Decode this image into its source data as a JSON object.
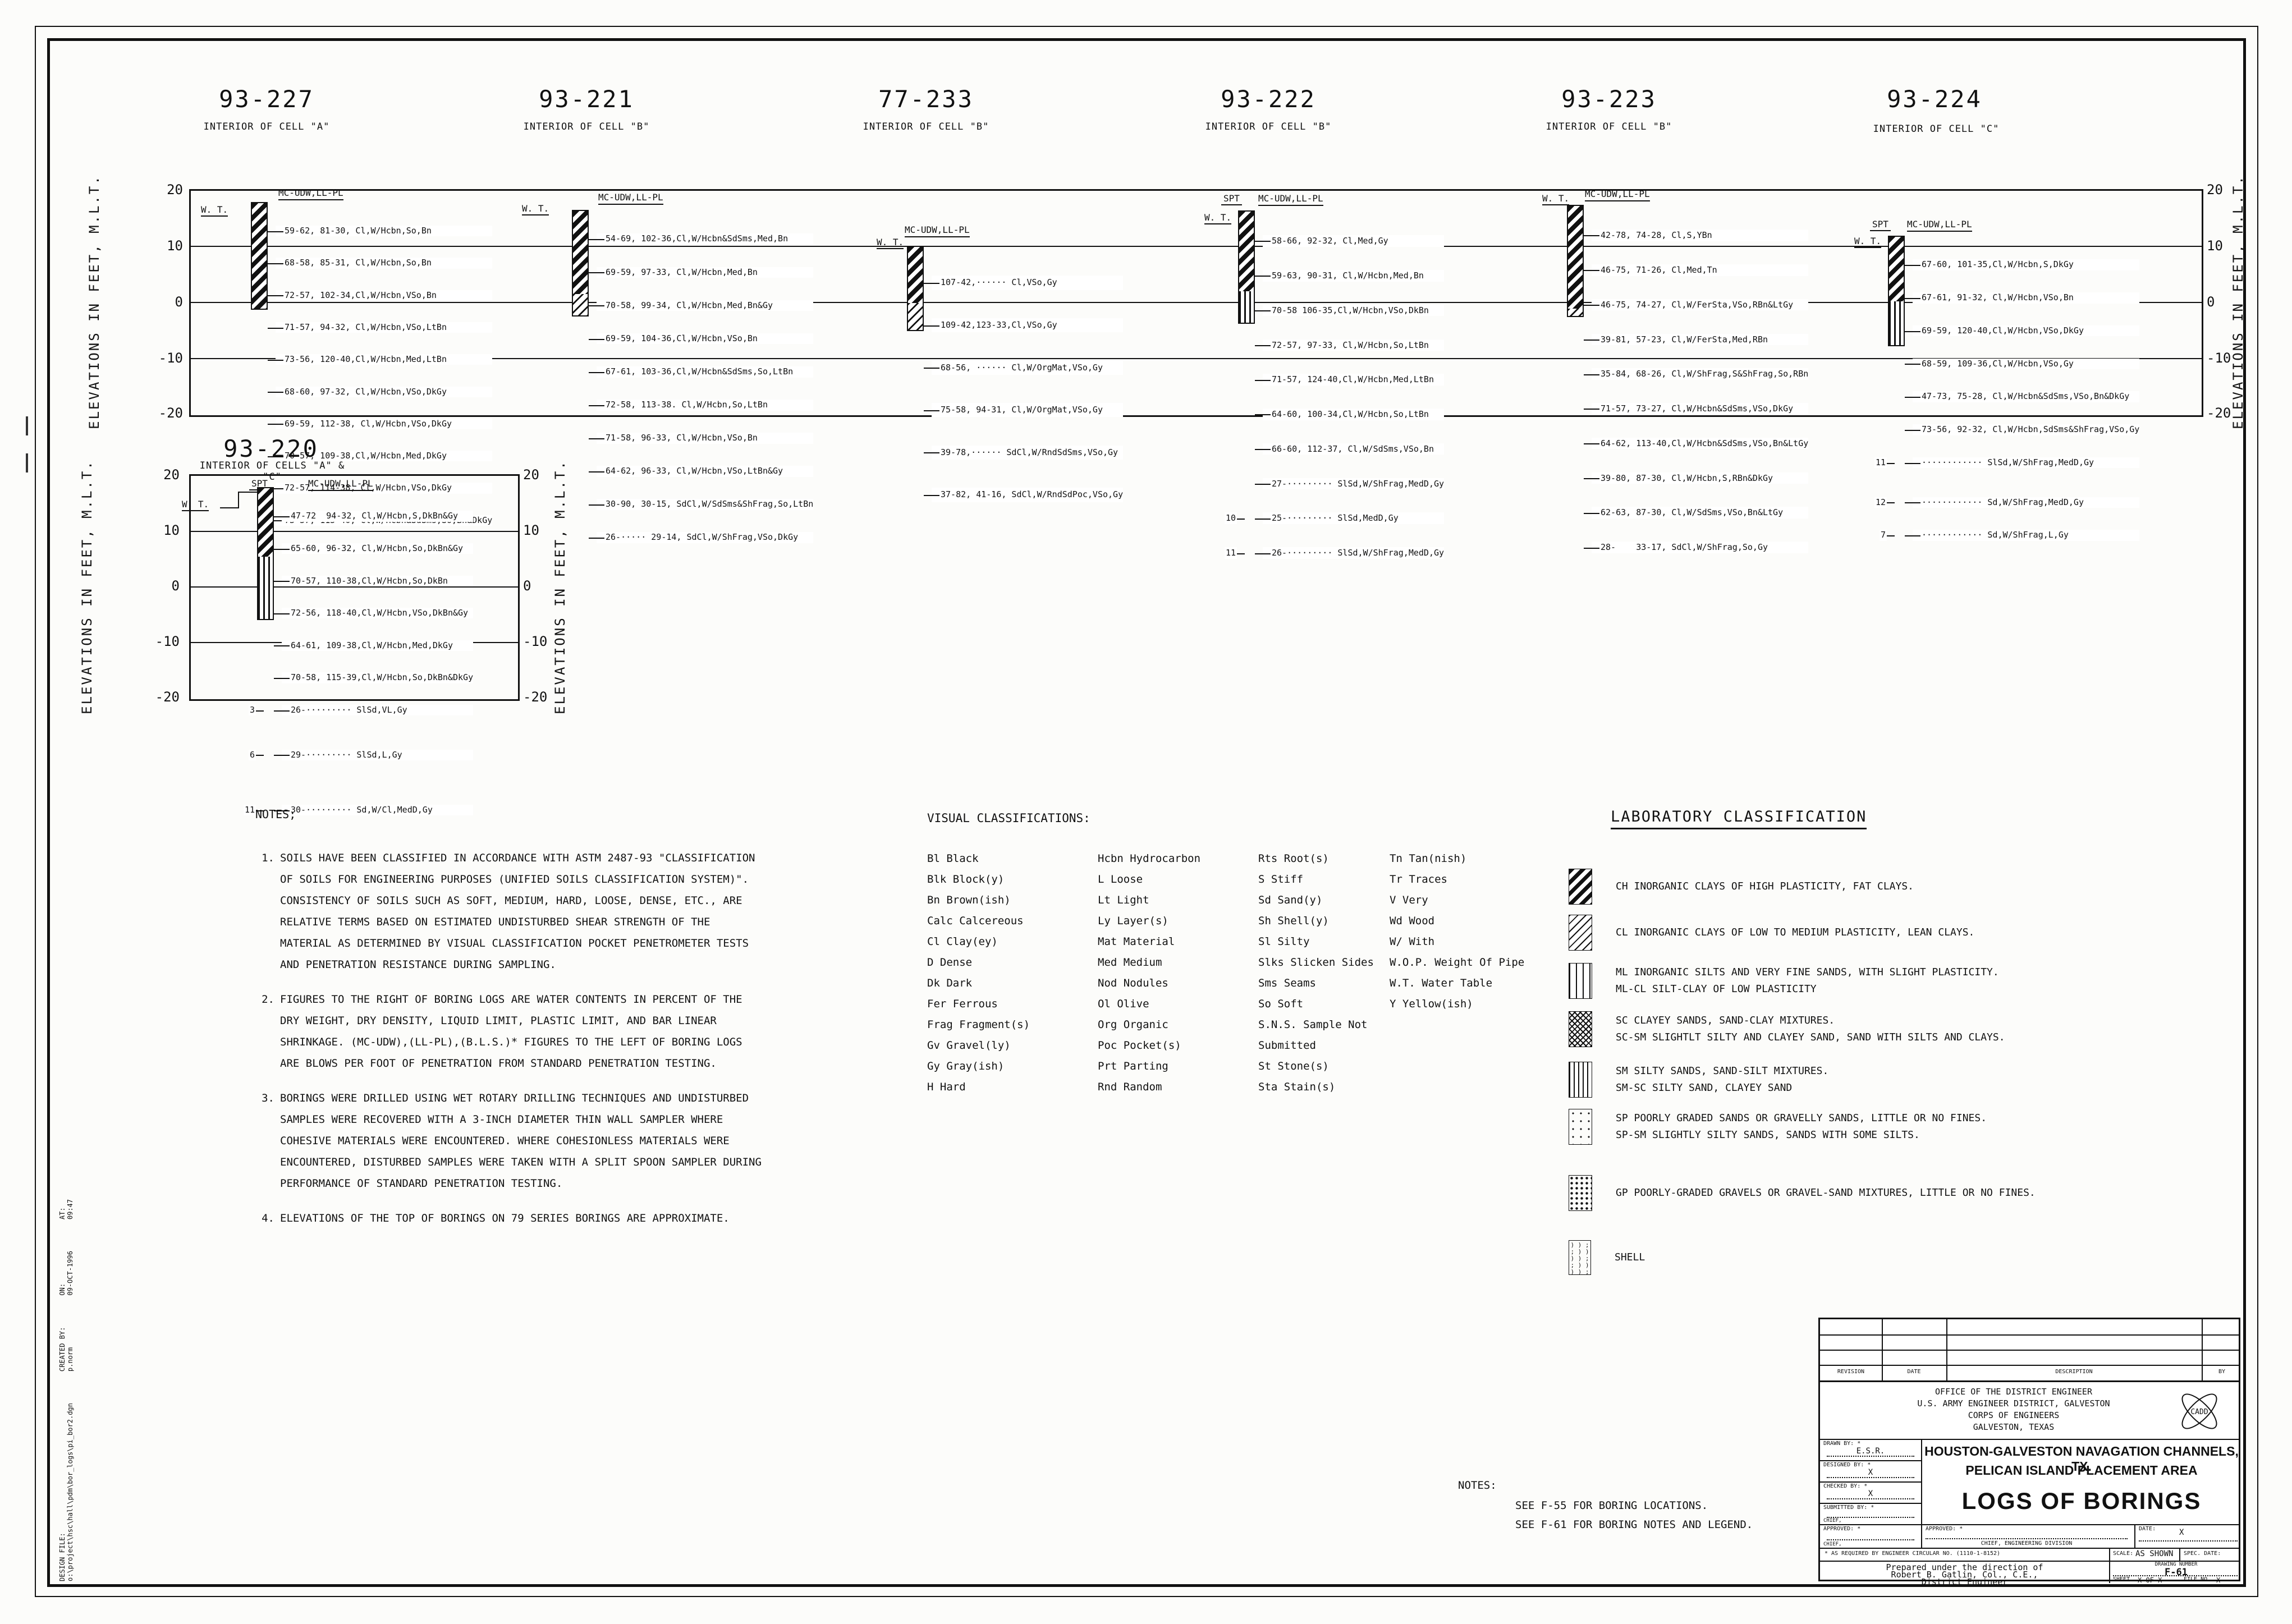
{
  "sheet": {
    "axis_label": "ELEVATIONS IN FEET, M.L.T.",
    "ticks": [
      "20",
      "10",
      "0",
      "-10",
      "-20"
    ],
    "wt": "W. T.",
    "spt": "SPT",
    "mc": "MC-UDW,LL-PL"
  },
  "borings": {
    "b227": {
      "title": "93-227",
      "subtitle": "INTERIOR OF CELL \"A\"",
      "entries": [
        {
          "t": "59-62, 81-30, Cl,W/Hcbn,So,Bn"
        },
        {
          "t": "68-58, 85-31, Cl,W/Hcbn,So,Bn"
        },
        {
          "t": "72-57, 102-34,Cl,W/Hcbn,VSo,Bn"
        },
        {
          "t": "71-57, 94-32, Cl,W/Hcbn,VSo,LtBn"
        },
        {
          "t": "73-56, 120-40,Cl,W/Hcbn,Med,LtBn"
        },
        {
          "t": "68-60, 97-32, Cl,W/Hcbn,VSo,DkGy"
        },
        {
          "t": "69-59, 112-38, Cl,W/Hcbn,VSo,DkGy"
        },
        {
          "t": "70-57, 109-38,Cl,W/Hcbn,Med,DkGy"
        },
        {
          "t": "72-57, 114-38, Cl,W/Hcbn,VSo,DkGy"
        },
        {
          "t": "73-57, 115-40, Cl,W/Hcbn&SdSms,So,Bn&DkGy"
        }
      ]
    },
    "b221": {
      "title": "93-221",
      "subtitle": "INTERIOR OF CELL \"B\"",
      "entries": [
        {
          "t": "54-69, 102-36,Cl,W/Hcbn&SdSms,Med,Bn"
        },
        {
          "t": "69-59, 97-33, Cl,W/Hcbn,Med,Bn"
        },
        {
          "t": "70-58, 99-34, Cl,W/Hcbn,Med,Bn&Gy"
        },
        {
          "t": "69-59, 104-36,Cl,W/Hcbn,VSo,Bn"
        },
        {
          "t": "67-61, 103-36,Cl,W/Hcbn&SdSms,So,LtBn"
        },
        {
          "t": "72-58, 113-38. Cl,W/Hcbn,So,LtBn"
        },
        {
          "t": "71-58, 96-33, Cl,W/Hcbn,VSo,Bn"
        },
        {
          "t": "64-62, 96-33, Cl,W/Hcbn,VSo,LtBn&Gy"
        },
        {
          "t": "30-90, 30-15, SdCl,W/SdSms&ShFrag,So,LtBn"
        },
        {
          "t": "26-····· 29-14, SdCl,W/ShFrag,VSo,DkGy"
        }
      ]
    },
    "b233": {
      "title": "77-233",
      "subtitle": "INTERIOR OF CELL \"B\"",
      "entries": [
        {
          "t": "107-42,······ Cl,VSo,Gy"
        },
        {
          "t": "109-42,123-33,Cl,VSo,Gy"
        },
        {
          "t": "68-56, ······ Cl,W/OrgMat,VSo,Gy"
        },
        {
          "t": "75-58, 94-31, Cl,W/OrgMat,VSo,Gy"
        },
        {
          "t": "39-78,······ SdCl,W/RndSdSms,VSo,Gy"
        },
        {
          "t": "37-82, 41-16, SdCl,W/RndSdPoc,VSo,Gy"
        }
      ]
    },
    "b222": {
      "title": "93-222",
      "subtitle": "INTERIOR OF CELL \"B\"",
      "entries": [
        {
          "t": "58-66, 92-32, Cl,Med,Gy"
        },
        {
          "t": "59-63, 90-31, Cl,W/Hcbn,Med,Bn"
        },
        {
          "t": "70-58 106-35,Cl,W/Hcbn,VSo,DkBn"
        },
        {
          "t": "72-57, 97-33, Cl,W/Hcbn,So,LtBn"
        },
        {
          "t": "71-57, 124-40,Cl,W/Hcbn,Med,LtBn"
        },
        {
          "t": "64-60, 100-34,Cl,W/Hcbn,So,LtBn"
        },
        {
          "t": "66-60, 112-37, Cl,W/SdSms,VSo,Bn"
        },
        {
          "t": "27-········· SlSd,W/ShFrag,MedD,Gy"
        },
        {
          "l": "10",
          "t": "25-········· SlSd,MedD,Gy"
        },
        {
          "l": "11",
          "t": "26-········· SlSd,W/ShFrag,MedD,Gy"
        }
      ]
    },
    "b223": {
      "title": "93-223",
      "subtitle": "INTERIOR OF CELL \"B\"",
      "entries": [
        {
          "t": "42-78, 74-28, Cl,S,YBn"
        },
        {
          "t": "46-75, 71-26, Cl,Med,Tn"
        },
        {
          "t": "46-75, 74-27, Cl,W/FerSta,VSo,RBn&LtGy"
        },
        {
          "t": "39-81, 57-23, Cl,W/FerSta,Med,RBn"
        },
        {
          "t": "35-84, 68-26, Cl,W/ShFrag,S&ShFrag,So,RBn"
        },
        {
          "t": "71-57, 73-27, Cl,W/Hcbn&SdSms,VSo,DkGy"
        },
        {
          "t": "64-62, 113-40,Cl,W/Hcbn&SdSms,VSo,Bn&LtGy"
        },
        {
          "t": "39-80, 87-30, Cl,W/Hcbn,S,RBn&DkGy"
        },
        {
          "t": "62-63, 87-30, Cl,W/SdSms,VSo,Bn&LtGy"
        },
        {
          "t": "28-    33-17, SdCl,W/ShFrag,So,Gy"
        }
      ]
    },
    "b224": {
      "title": "93-224",
      "subtitle": "INTERIOR OF CELL \"C\"",
      "entries": [
        {
          "t": "67-60, 101-35,Cl,W/Hcbn,S,DkGy"
        },
        {
          "t": "67-61, 91-32, Cl,W/Hcbn,VSo,Bn"
        },
        {
          "t": "69-59, 120-40,Cl,W/Hcbn,VSo,DkGy"
        },
        {
          "t": "68-59, 109-36,Cl,W/Hcbn,VSo,Gy"
        },
        {
          "t": "47-73, 75-28, Cl,W/Hcbn&SdSms,VSo,Bn&DkGy"
        },
        {
          "t": "73-56, 92-32, Cl,W/Hcbn,SdSms&ShFrag,VSo,Gy"
        },
        {
          "l": "11",
          "t": "············ SlSd,W/ShFrag,MedD,Gy"
        },
        {
          "l": "12",
          "t": "············ Sd,W/ShFrag,MedD,Gy"
        },
        {
          "l": "7",
          "t": "············ Sd,W/ShFrag,L,Gy"
        }
      ]
    },
    "b220": {
      "title": "93-220",
      "subtitle": "INTERIOR OF CELLS \"A\" & \"C\"",
      "entries": [
        {
          "t": "47-72  94-32, Cl,W/Hcbn,S,DkBn&Gy"
        },
        {
          "t": "65-60, 96-32, Cl,W/Hcbn,So,DkBn&Gy"
        },
        {
          "t": "70-57, 110-38,Cl,W/Hcbn,So,DkBn"
        },
        {
          "t": "72-56, 118-40,Cl,W/Hcbn,VSo,DkBn&Gy"
        },
        {
          "t": "64-61, 109-38,Cl,W/Hcbn,Med,DkGy"
        },
        {
          "t": "70-58, 115-39,Cl,W/Hcbn,So,DkBn&DkGy"
        },
        {
          "l": "3",
          "t": "26-········· SlSd,VL,Gy"
        },
        {
          "l": "6",
          "t": "29-········· SlSd,L,Gy"
        },
        {
          "l": "11",
          "t": "30-········· Sd,W/Cl,MedD,Gy"
        }
      ]
    }
  },
  "notes": {
    "title": "NOTES;",
    "items": [
      {
        "n": "1.",
        "t": "SOILS HAVE BEEN CLASSIFIED IN ACCORDANCE WITH ASTM 2487-93 \"CLASSIFICATION OF SOILS FOR ENGINEERING PURPOSES (UNIFIED SOILS CLASSIFICATION SYSTEM)\". CONSISTENCY OF SOILS SUCH AS SOFT, MEDIUM, HARD, LOOSE, DENSE, ETC., ARE RELATIVE TERMS BASED ON ESTIMATED UNDISTURBED SHEAR STRENGTH OF THE MATERIAL AS DETERMINED BY VISUAL CLASSIFICATION POCKET PENETROMETER TESTS AND PENETRATION RESISTANCE DURING SAMPLING."
      },
      {
        "n": "2.",
        "t": "FIGURES TO THE RIGHT OF BORING LOGS ARE WATER CONTENTS IN PERCENT OF THE DRY WEIGHT, DRY DENSITY, LIQUID LIMIT, PLASTIC LIMIT, AND BAR LINEAR SHRINKAGE. (MC-UDW),(LL-PL),(B.L.S.)* FIGURES TO THE LEFT OF BORING LOGS ARE BLOWS PER FOOT OF PENETRATION FROM STANDARD PENETRATION TESTING."
      },
      {
        "n": "3.",
        "t": "BORINGS WERE DRILLED USING WET ROTARY DRILLING TECHNIQUES AND UNDISTURBED SAMPLES WERE RECOVERED WITH A 3-INCH DIAMETER THIN WALL SAMPLER WHERE COHESIVE MATERIALS WERE ENCOUNTERED.  WHERE COHESIONLESS MATERIALS WERE ENCOUNTERED, DISTURBED SAMPLES WERE  TAKEN WITH A SPLIT SPOON SAMPLER DURING PERFORMANCE OF STANDARD PENETRATION TESTING."
      },
      {
        "n": "4.",
        "t": "ELEVATIONS OF THE TOP OF BORINGS ON 79 SERIES BORINGS ARE APPROXIMATE."
      }
    ]
  },
  "visual": {
    "title": "VISUAL CLASSIFICATIONS:",
    "col1": "Bl Black\nBlk Block(y)\nBn Brown(ish)\nCalc Calcereous\nCl Clay(ey)\nD Dense\nDk Dark\nFer Ferrous\nFrag Fragment(s)\nGv Gravel(ly)\nGy Gray(ish)\nH Hard",
    "col2": "Hcbn Hydrocarbon\nL Loose\nLt Light\nLy Layer(s)\nMat Material\nMed Medium\nNod Nodules\nOl Olive\nOrg Organic\nPoc Pocket(s)\nPrt Parting\nRnd Random",
    "col3": "Rts Root(s)\nS Stiff\nSd Sand(y)\nSh Shell(y)\nSl Silty\nSlks Slicken Sides\nSms Seams\nSo Soft\nS.N.S. Sample Not\n            Submitted\nSt Stone(s)\nSta Stain(s)",
    "col4": "Tn Tan(nish)\nTr Traces\nV Very\nWd Wood\nW/ With\nW.O.P. Weight Of Pipe\nW.T. Water Table\nY Yellow(ish)"
  },
  "lab": {
    "title": "LABORATORY CLASSIFICATION",
    "ch": "CH INORGANIC CLAYS OF HIGH PLASTICITY, FAT CLAYS.",
    "cl": "CL INORGANIC CLAYS OF LOW TO MEDIUM PLASTICITY, LEAN CLAYS.",
    "ml": "ML INORGANIC SILTS AND VERY FINE SANDS, WITH SLIGHT PLASTICITY.\nML-CL  SILT-CLAY OF LOW PLASTICITY",
    "sc": "SC CLAYEY SANDS, SAND-CLAY MIXTURES.\nSC-SM  SLIGHTLT SILTY AND CLAYEY SAND, SAND WITH SILTS AND CLAYS.",
    "sm": "SM SILTY SANDS, SAND-SILT MIXTURES.\nSM-SC SILTY SAND, CLAYEY SAND",
    "sp": "SP POORLY GRADED SANDS OR GRAVELLY SANDS, LITTLE OR NO FINES.\nSP-SM  SLIGHTLY SILTY SANDS, SANDS WITH SOME SILTS.",
    "gp": "GP POORLY-GRADED GRAVELS OR GRAVEL-SAND MIXTURES, LITTLE OR NO FINES.",
    "shell": "SHELL",
    "shell_sym": ") ) ;\n; ) )\n) ) ;\n; ) )\n) ) ;"
  },
  "refnotes": {
    "title": "NOTES:",
    "l1": "SEE F-55 FOR BORING LOCATIONS.",
    "l2": "SEE F-61 FOR BORING NOTES AND LEGEND."
  },
  "stamp": {
    "f1l": "DESIGN FILE:",
    "f1v": "o:\\project\\hsc\\hall\\pdm\\bor_logs\\pi_bor2.dgn",
    "f2l": "CREATED BY:",
    "f2v": "p.norm",
    "f3l": "ON:",
    "f3v": "09-OCT-1996",
    "f4l": "AT:",
    "f4v": "09:47"
  },
  "tb": {
    "rev": "REVISION",
    "date": "DATE",
    "desc": "DESCRIPTION",
    "by": "BY",
    "agency1": "OFFICE OF THE DISTRICT ENGINEER",
    "agency2": "U.S. ARMY ENGINEER DISTRICT, GALVESTON",
    "agency3": "CORPS OF ENGINEERS",
    "agency4": "GALVESTON, TEXAS",
    "cadd": "CADD",
    "drawn_l": "DRAWN BY: *",
    "drawn_v": "E.S.R.",
    "designed_l": "DESIGNED BY: *",
    "designed_v": "X",
    "checked_l": "CHECKED BY: *",
    "checked_v": "X",
    "submitted_l": "SUBMITTED BY: *",
    "chief1": "CHIEF,",
    "approved_l": "APPROVED: *",
    "chief2": "CHIEF,",
    "approved_c": "APPROVED: *",
    "chief_div": "CHIEF, ENGINEERING DIVISION",
    "date_l": "DATE:",
    "date_v": "X",
    "foot": "* AS REQUIRED BY ENGINEER CIRCULAR NO. (1110-1-8152)",
    "scale_l": "SCALE:",
    "scale_v": "AS SHOWN",
    "spec": "SPEC. DATE:",
    "prep1": "Prepared under the direction of",
    "prep2": "Robert B. Gatlin, Col., C.E.,",
    "prep3": "District Engineer",
    "dn_l": "DRAWING NUMBER",
    "dn_v": "F-61",
    "sheet_l": "SHEET",
    "sheet_v": "X OF X",
    "file_l": "FILE NO.",
    "file_v": "X",
    "proj1": "HOUSTON-GALVESTON NAVAGATION CHANNELS, TX.",
    "proj2": "PELICAN ISLAND PLACEMENT AREA",
    "main_title": "LOGS OF BORINGS"
  }
}
